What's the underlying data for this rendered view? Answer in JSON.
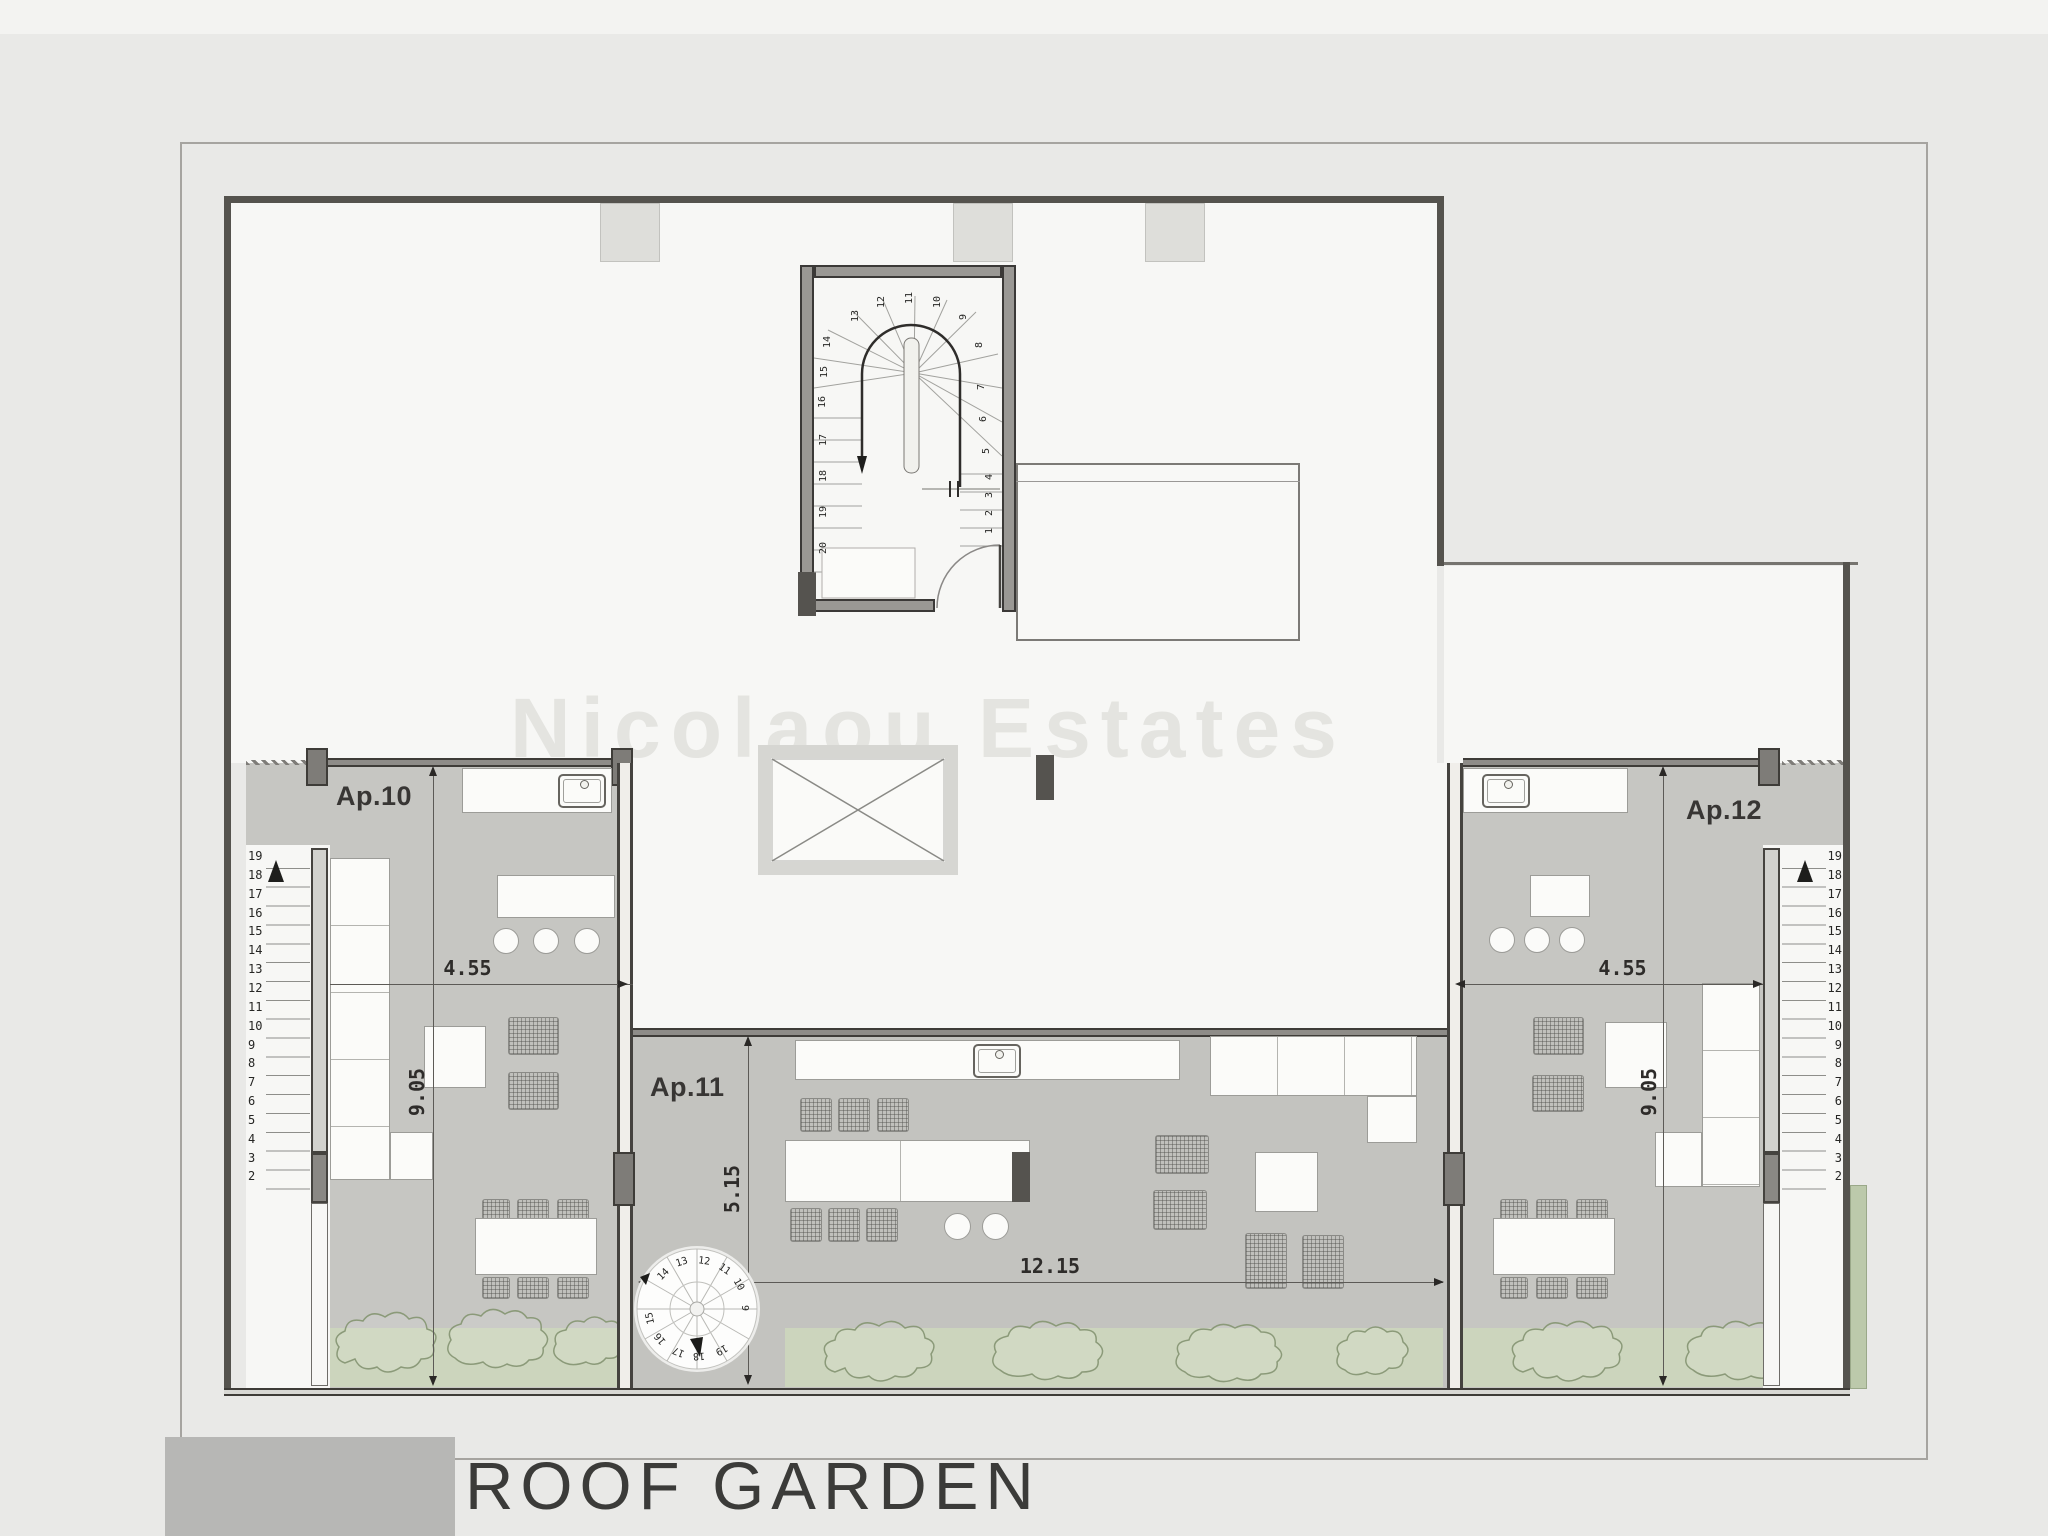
{
  "title": "ROOF GARDEN",
  "watermark": "Nicolaou Estates",
  "apartments": {
    "ap10": {
      "label": "Ap.10",
      "dim_width": "4.55",
      "dim_depth": "9.05"
    },
    "ap11": {
      "label": "Ap.11",
      "dim_width": "12.15",
      "dim_depth": "5.15"
    },
    "ap12": {
      "label": "Ap.12",
      "dim_width": "4.55",
      "dim_depth": "9.05"
    }
  },
  "stairs": {
    "main_numbers": [
      "1",
      "2",
      "3",
      "4",
      "5",
      "6",
      "7",
      "8",
      "9",
      "10",
      "11",
      "12",
      "13",
      "14",
      "15",
      "16",
      "17",
      "18",
      "19",
      "20"
    ],
    "left_numbers": [
      "19",
      "18",
      "17",
      "16",
      "15",
      "14",
      "13",
      "12",
      "11",
      "10",
      "9",
      "8",
      "7",
      "6",
      "5",
      "4",
      "3",
      "2"
    ],
    "right_numbers": [
      "19",
      "18",
      "17",
      "16",
      "15",
      "14",
      "13",
      "12",
      "11",
      "10",
      "9",
      "8",
      "7",
      "6",
      "5",
      "4",
      "3",
      "2"
    ],
    "spiral_numbers": [
      "9",
      "10",
      "11",
      "12",
      "13",
      "14",
      "15",
      "16",
      "17",
      "18",
      "19"
    ]
  },
  "colors": {
    "page": "#e9e9e7",
    "roof_white": "#f7f7f5",
    "terrace_grey": "#c6c6c2",
    "garden_green": "#ccd5bd",
    "wall_dark": "#55534e"
  }
}
